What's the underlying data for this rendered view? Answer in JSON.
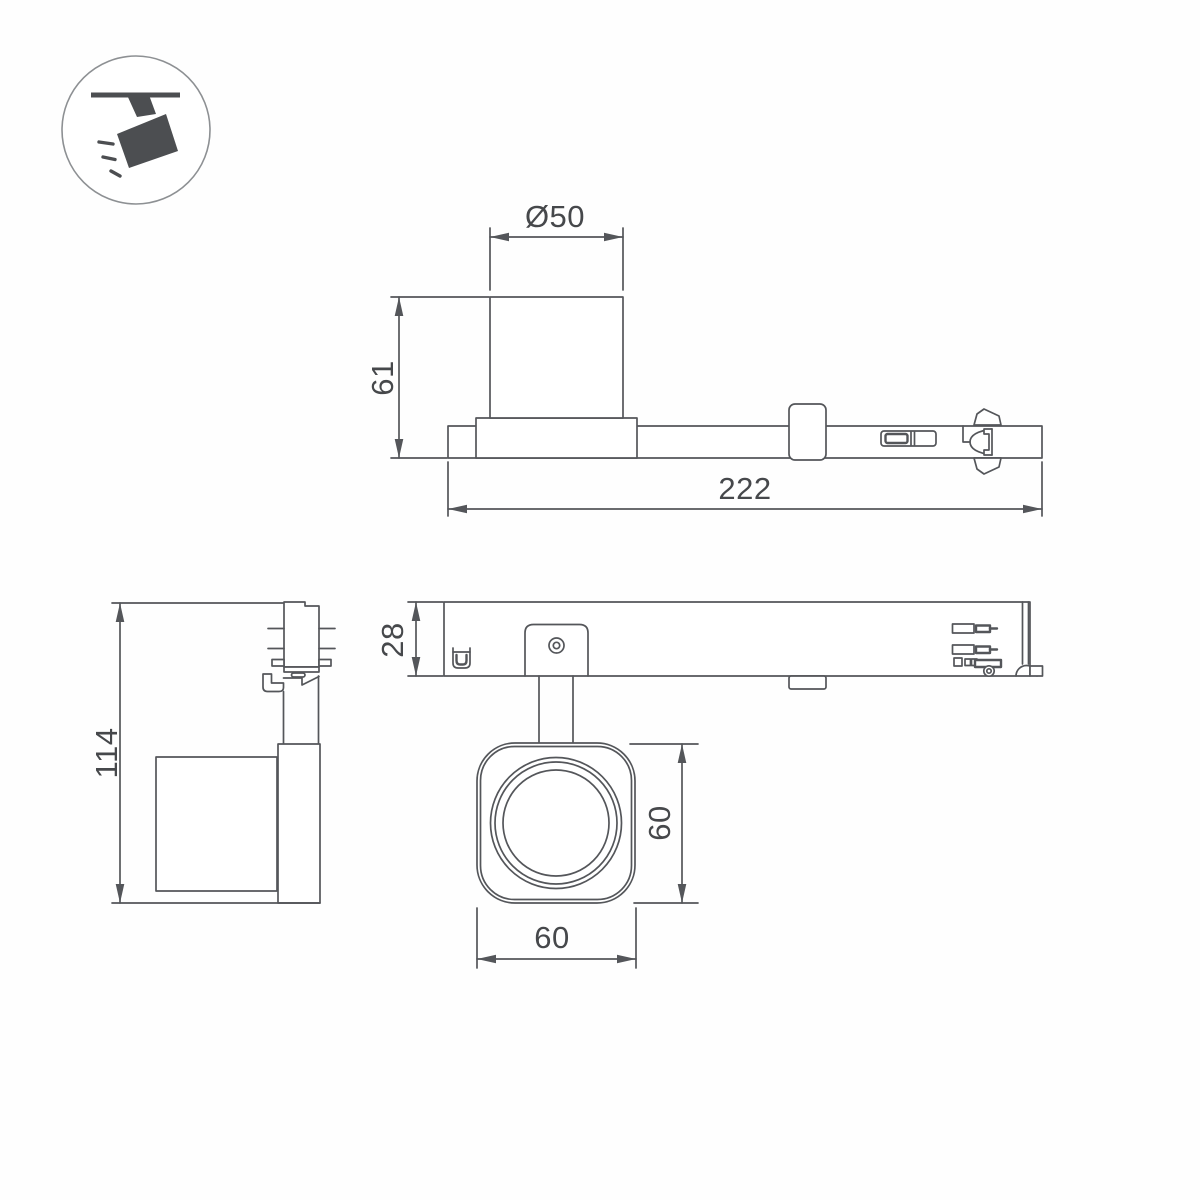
{
  "colors": {
    "background": "#fefefe",
    "line": "#54565a",
    "dimension_text": "#46484b",
    "icon_fill": "#4c4e51",
    "icon_ring": "#8d9093"
  },
  "icon": {
    "name": "track-spotlight"
  },
  "views": {
    "side": {
      "dim_diameter": "Ø50",
      "dim_height": "61",
      "dim_length": "222"
    },
    "front": {
      "dim_height": "114"
    },
    "plan": {
      "dim_depth": "28",
      "dim_head_height": "60",
      "dim_head_width": "60"
    }
  }
}
